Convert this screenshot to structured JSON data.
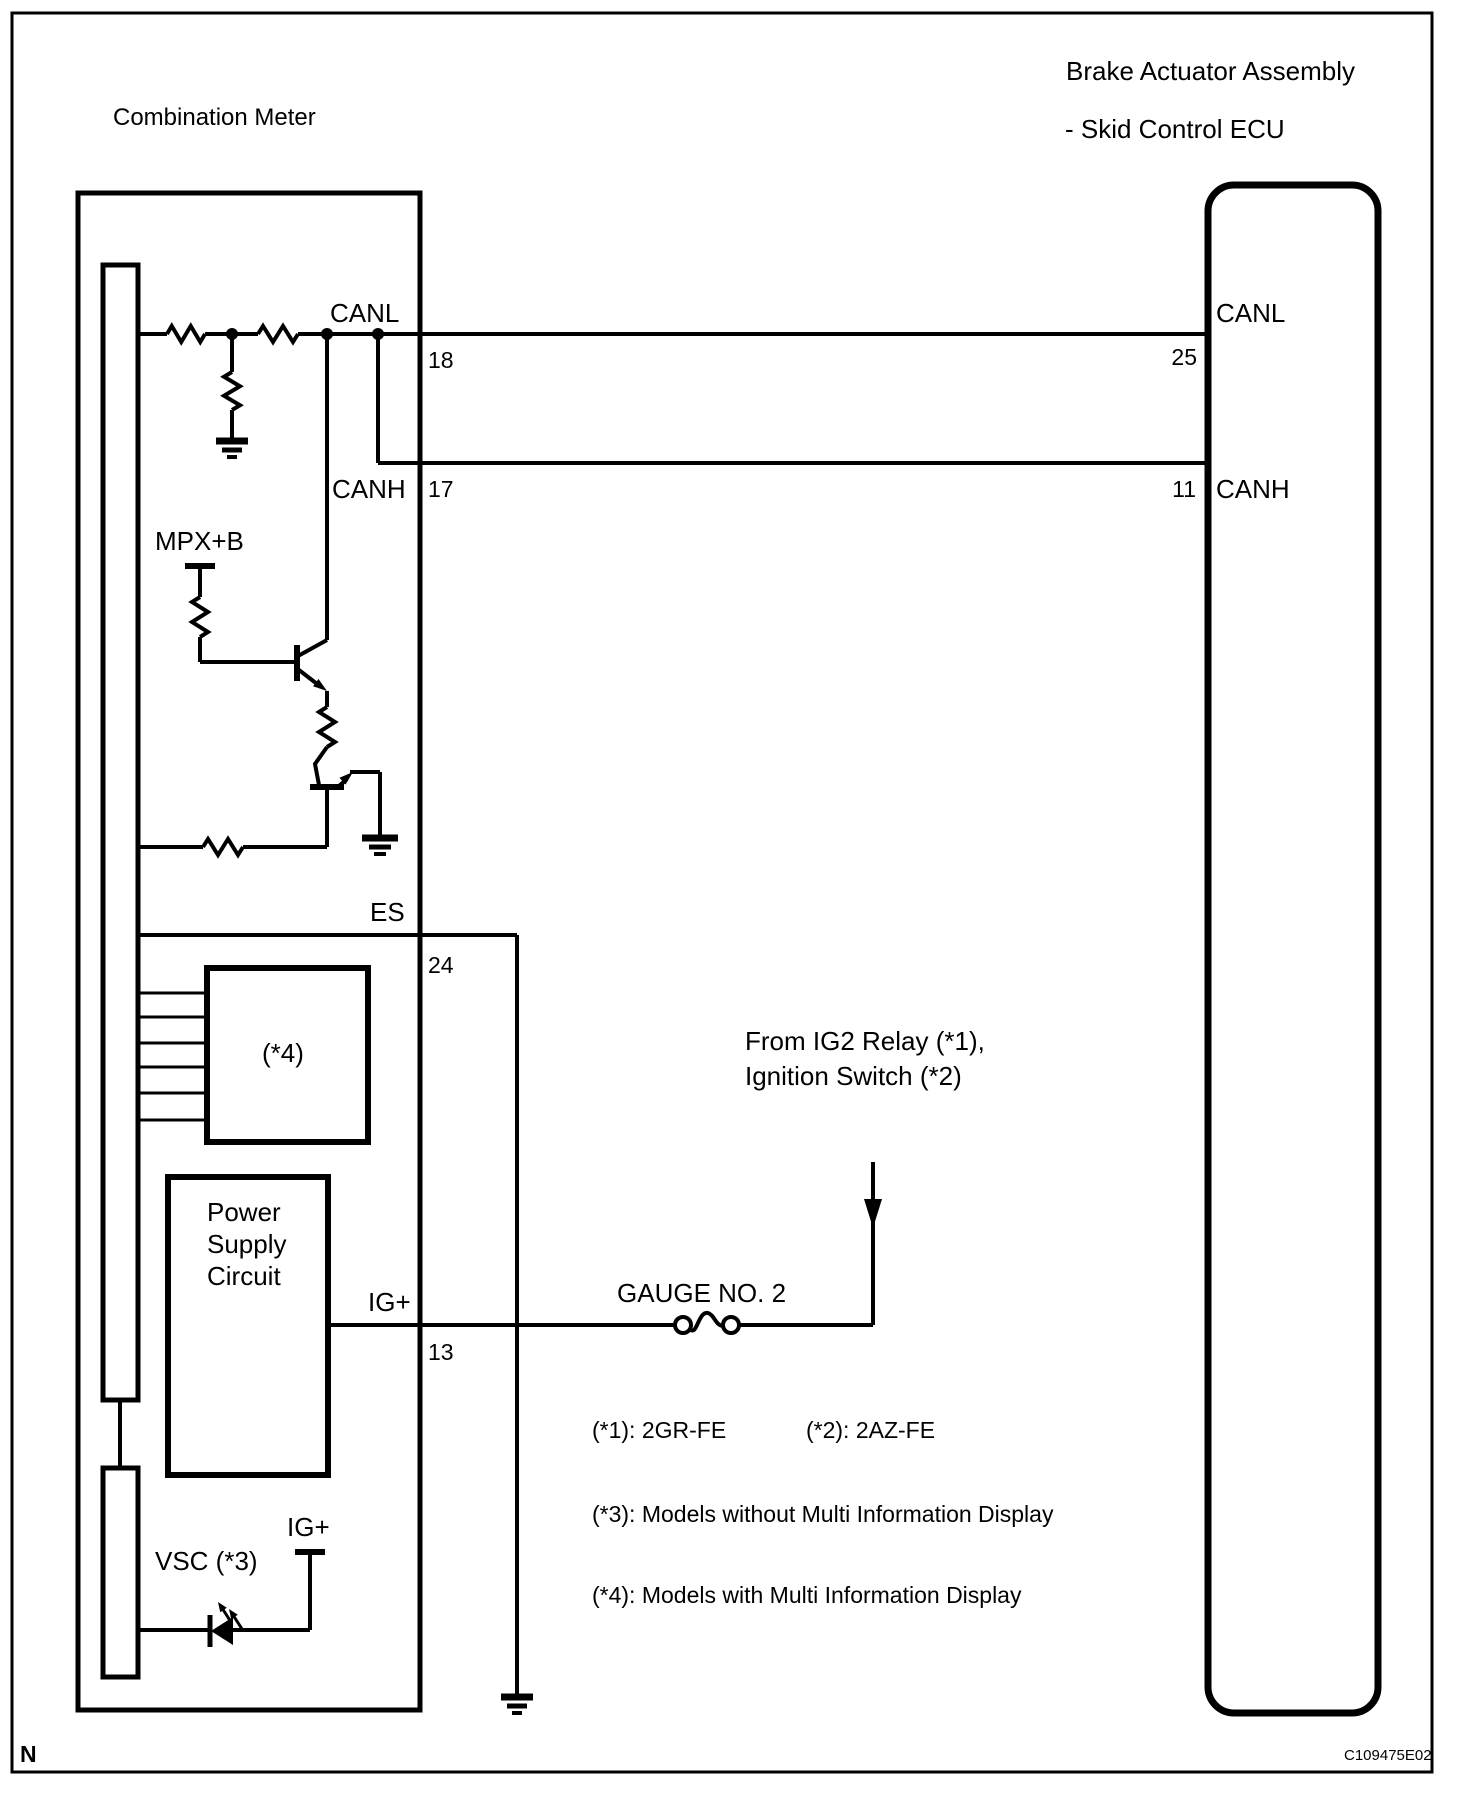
{
  "page": {
    "background": "#ffffff",
    "ink": "#000000"
  },
  "header": {
    "left_title": "Combination Meter",
    "right_title_line1": "Brake Actuator Assembly",
    "right_title_line2": "- Skid Control ECU"
  },
  "meter": {
    "canl_label": "CANL",
    "canl_pin": "18",
    "canh_label": "CANH",
    "canh_pin": "17",
    "mpxb_label": "MPX+B",
    "es_label": "ES",
    "es_pin": "24",
    "display_box_label": "(*4)",
    "psu_line1": "Power",
    "psu_line2": "Supply",
    "psu_line3": "Circuit",
    "ig_label": "IG+",
    "ig_pin": "13",
    "vsc_label": "VSC (*3)",
    "vsc_ig_label": "IG+"
  },
  "ecu": {
    "canl_label": "CANL",
    "canl_pin": "25",
    "canh_label": "CANH",
    "canh_pin": "11"
  },
  "middle": {
    "source_line1": "From IG2 Relay (*1),",
    "source_line2": "Ignition Switch (*2)",
    "fuse_label": "GAUGE NO. 2"
  },
  "notes": {
    "line1a": "(*1): 2GR-FE",
    "line1b": "(*2): 2AZ-FE",
    "line2": "(*3): Models without Multi Information Display",
    "line3": "(*4): Models with Multi Information Display"
  },
  "footer": {
    "page_mark": "N",
    "figure_code": "C109475E02"
  }
}
